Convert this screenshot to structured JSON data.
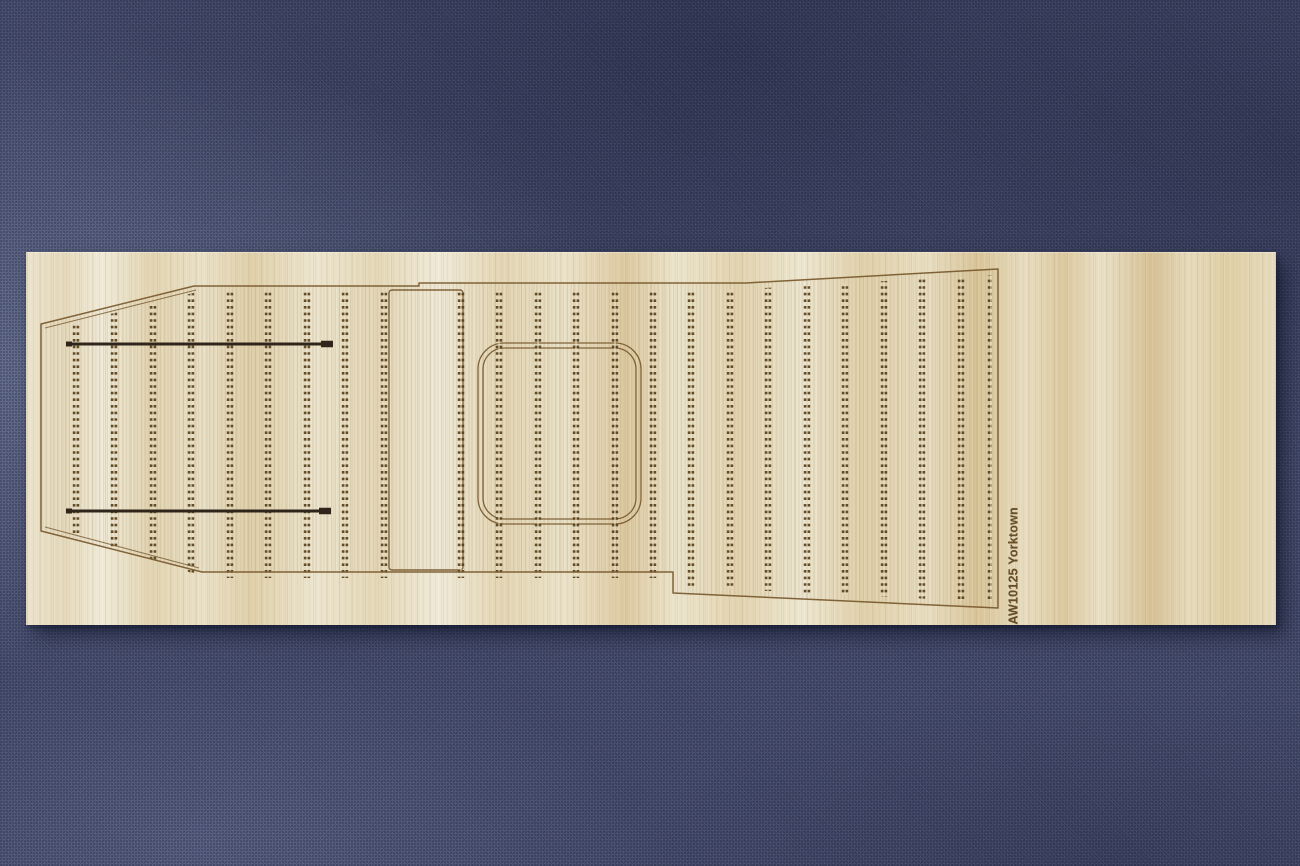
{
  "scene": {
    "description": "Photograph of a laser-engraved wooden flight-deck veneer sheet for a model aircraft carrier kit, lying on blue-grey woven fabric",
    "fabric_color": "#4a5172",
    "shadow_color": "rgba(12,16,36,0.55)"
  },
  "sheet": {
    "label_text": "AW10125 Yorktown",
    "label_color": "#5c431d",
    "wood_base_color": "#e8dfc4",
    "engraving_color": "#7a5c30"
  },
  "deck": {
    "outline_points": [
      [
        14,
        71
      ],
      [
        167,
        33
      ],
      [
        392,
        33
      ],
      [
        392,
        30
      ],
      [
        719,
        30
      ],
      [
        971,
        16
      ],
      [
        971,
        355
      ],
      [
        646,
        340
      ],
      [
        646,
        319
      ],
      [
        175,
        319
      ],
      [
        14,
        278
      ]
    ],
    "inner_bow_lines": [
      [
        18,
        75,
        169,
        37
      ],
      [
        18,
        274,
        172,
        315
      ]
    ],
    "clip_points": [
      [
        20,
        77
      ],
      [
        170,
        39
      ],
      [
        393,
        39
      ],
      [
        719,
        36
      ],
      [
        965,
        22
      ],
      [
        965,
        349
      ],
      [
        640,
        333
      ],
      [
        640,
        325
      ],
      [
        180,
        325
      ],
      [
        20,
        272
      ]
    ],
    "forward_elevator_rect": {
      "x": 362,
      "y": 37,
      "w": 74,
      "h": 280,
      "r": 3
    },
    "aft_elevator_outer": {
      "x": 451,
      "y": 90,
      "w": 163,
      "h": 181,
      "r": 26
    },
    "aft_elevator_inner": {
      "x": 456,
      "y": 95,
      "w": 153,
      "h": 171,
      "r": 21
    },
    "tiedown_columns_x": [
      49,
      87,
      126,
      164,
      203,
      241,
      280,
      318,
      357,
      434,
      472,
      511,
      549,
      588,
      626,
      664,
      703,
      741,
      780,
      818,
      857,
      895,
      934,
      964
    ],
    "tiedown_color": "#57411d",
    "tiedown_split_color": "#e9dfc4",
    "arresting_wires": [
      {
        "x1": 40,
        "x2": 304,
        "y": 91
      },
      {
        "x1": 40,
        "x2": 302,
        "y": 258
      }
    ],
    "wire_color": "#30251a",
    "plank_seam_color": "rgba(122,92,48,0.15)"
  }
}
